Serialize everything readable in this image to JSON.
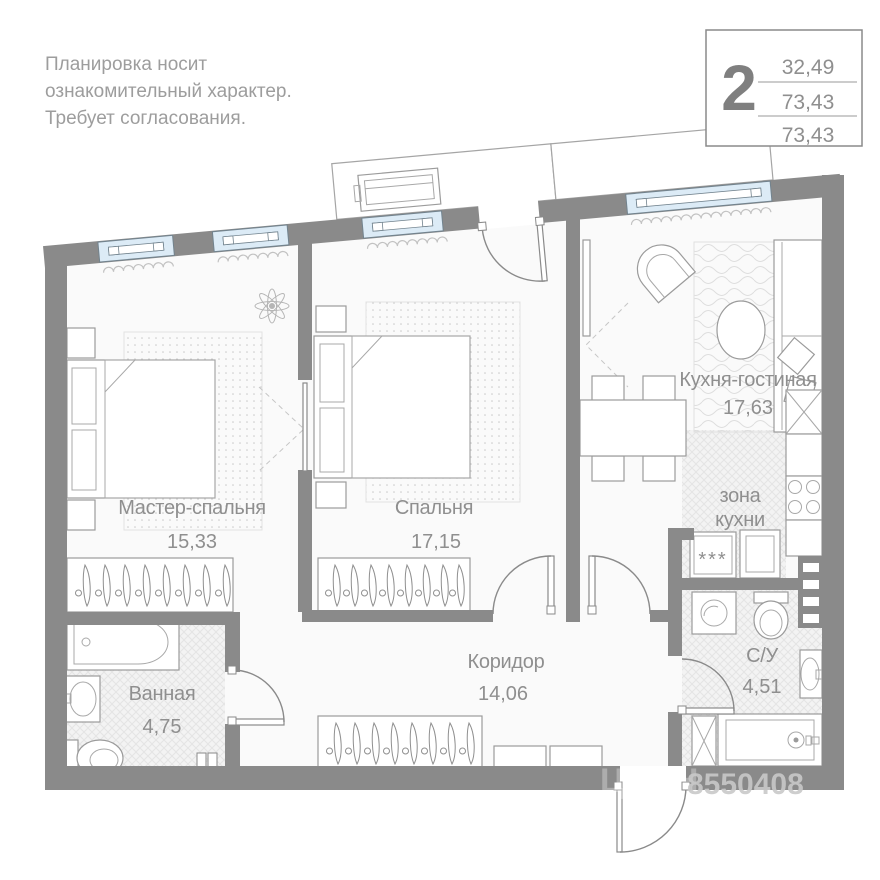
{
  "disclaimer": {
    "lines": [
      "Планировка носит",
      "ознакомительный характер.",
      "Требует согласования."
    ]
  },
  "info_box": {
    "room_count": "2",
    "areas": [
      "32,49",
      "73,43",
      "73,43"
    ]
  },
  "rooms": {
    "master_bedroom": {
      "name": "Мастер-спальня",
      "area": "15,33"
    },
    "bedroom": {
      "name": "Спальня",
      "area": "17,15"
    },
    "kitchen_living": {
      "name": "Кухня-гостиная",
      "area": "17,63"
    },
    "kitchen_zone": {
      "name_lines": [
        "зона",
        "кухни"
      ]
    },
    "bathroom": {
      "name": "Ванная",
      "area": "4,75"
    },
    "corridor": {
      "name": "Коридор",
      "area": "14,06"
    },
    "wc": {
      "name": "С/У",
      "area": "4,51"
    }
  },
  "appliances": {
    "fridge_stars": "***"
  },
  "watermark": {
    "brand": "ЦИАН",
    "id": "8550408"
  },
  "colors": {
    "wall": "#8a8a8a",
    "window": "#dcebf6",
    "text": "#8f8f8f",
    "accent_blue": "#dcebf6"
  }
}
